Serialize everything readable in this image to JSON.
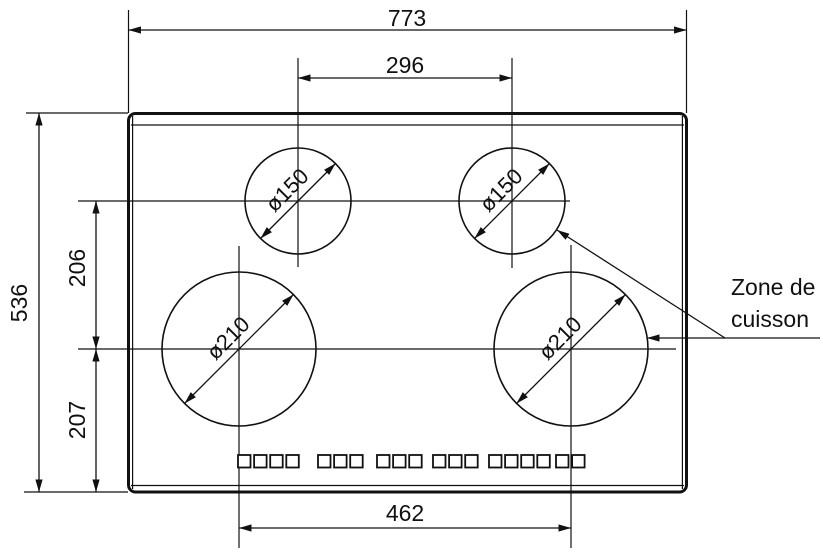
{
  "diagram": {
    "type": "technical-drawing",
    "view": "cooktop-top-view",
    "dimensions": {
      "overall_width": "773",
      "top_burners_center_distance": "296",
      "overall_depth": "536",
      "top_row_to_bottom_row": "206",
      "bottom_row_to_front_edge": "207",
      "bottom_burners_center_distance": "462"
    },
    "burners": [
      {
        "position": "top-left",
        "diameter_label": "ø150"
      },
      {
        "position": "top-right",
        "diameter_label": "ø150"
      },
      {
        "position": "bottom-left",
        "diameter_label": "ø210"
      },
      {
        "position": "bottom-right",
        "diameter_label": "ø210"
      }
    ],
    "zone_label": {
      "line1": "Zone de",
      "line2": "cuisson"
    },
    "control_buttons": {
      "groups": [
        4,
        3,
        3,
        3,
        4,
        2
      ]
    },
    "colors": {
      "line": "#111111",
      "background": "#ffffff"
    }
  }
}
